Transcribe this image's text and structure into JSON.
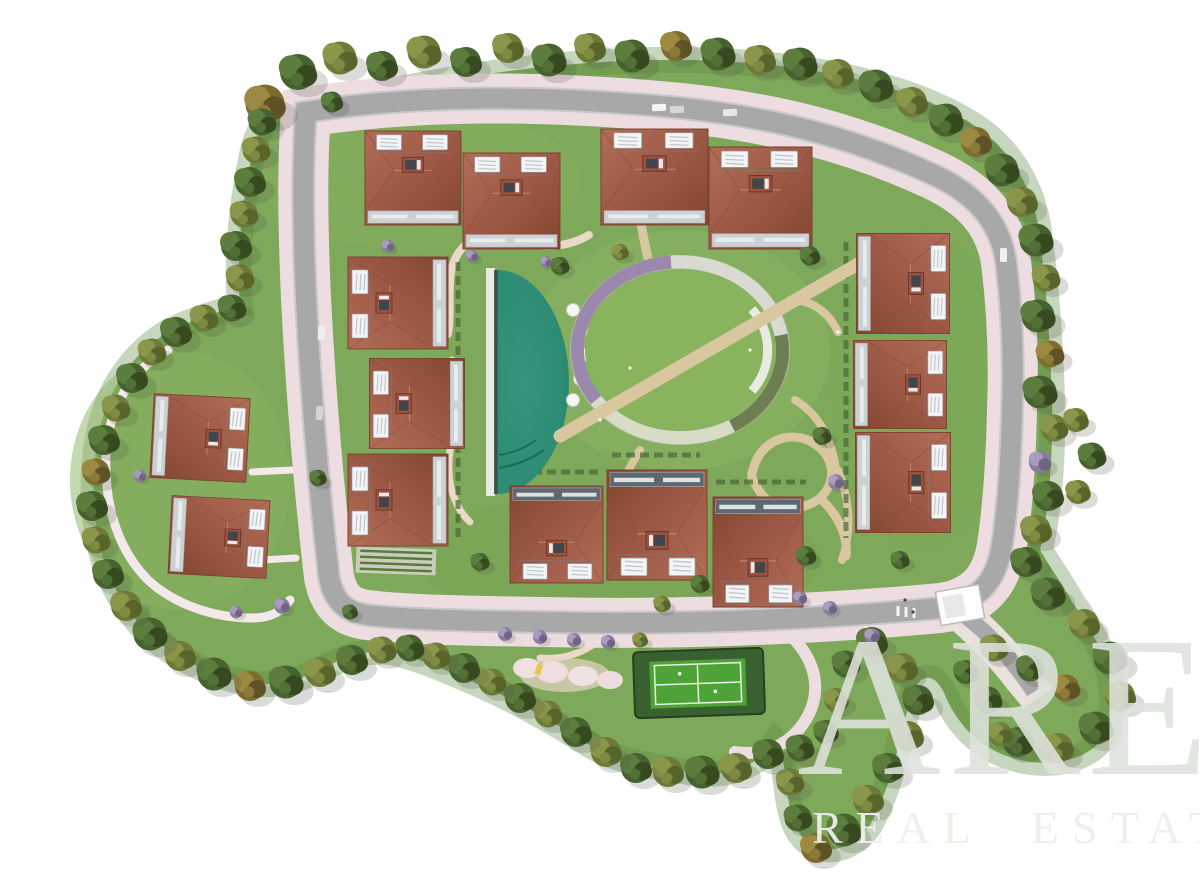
{
  "watermark": {
    "brand": "ARE",
    "tagline": "REAL ESTATE"
  },
  "scene": {
    "type": "aerial-top-view-3d-render",
    "subject": "Aerial site plan render of a gated residential villa development with central gardens",
    "building_count": 15,
    "building_groups": {
      "top_row": 4,
      "inner_west_column": 3,
      "east_column": 3,
      "south_row": 3,
      "west_cluster": 2
    },
    "pool_parasol_count": 5,
    "amenities": [
      "swimming-pool",
      "pool-parasols",
      "central-oval-garden",
      "flower-pergola-ring",
      "tennis-court",
      "playground",
      "entrance-gatehouse",
      "perimeter-loop-road",
      "walking-paths",
      "perimeter-trees"
    ]
  },
  "palette": {
    "background": "#ffffff",
    "lawn": "#7fa95a",
    "road": "#a8a8a8",
    "sidewalk_pink": "#eddde1",
    "roof_terracotta": "#9a5743",
    "pool_teal": "#2a8a72",
    "court_green": "#4ea337",
    "tree_dark_green": "#46622e",
    "tree_olive": "#6e7a38",
    "tree_autumn": "#7d6b30",
    "tree_purple": "#8a7d9c",
    "watermark_gray": "#dfe3dd"
  }
}
